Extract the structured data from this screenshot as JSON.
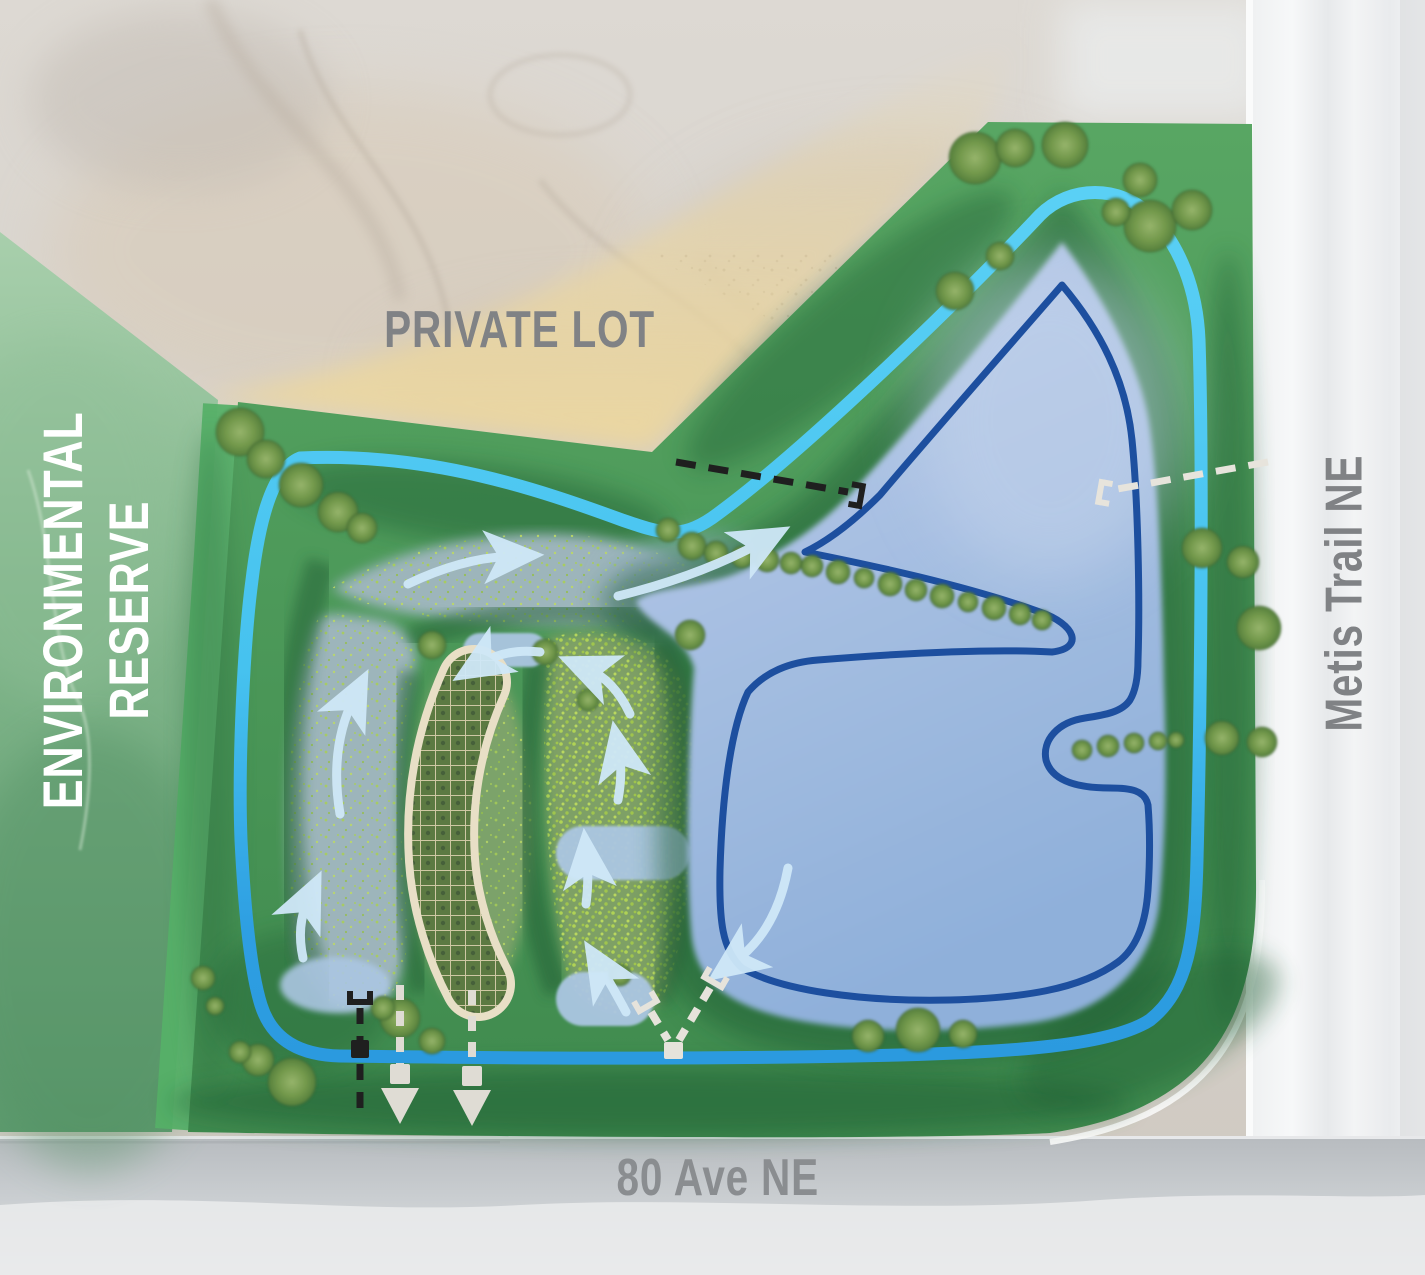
{
  "page": {
    "type": "stormwater pond and wetland landscape site plan"
  },
  "labels": {
    "private_lot": "PRIVATE LOT",
    "reserve_line1": "ENVIRONMENTAL",
    "reserve_line2": "RESERVE",
    "metis_trail": "Metis Trail NE",
    "ave_80": "80 Ave NE"
  },
  "features": {
    "pond": "stormwater-pond",
    "waterline": "normal-water-level-outline",
    "wetland": "constructed-wetland-marsh-cells",
    "grid_cell": "gridded-wetland-boardwalk-structure",
    "loop_path": "perimeter-pathway-loop",
    "flow_arrows": "water-flow-arrow-icon",
    "black_pipe": "storm-pipe-dashed-black-icon",
    "white_pipe": "storm-pipe-dashed-white-icon",
    "tee_marker": "pipe-inlet-tee-icon",
    "square_marker": "manhole-square-icon",
    "down_arrow": "outfall-arrow-icon",
    "tree": "tree-icon"
  },
  "colors": {
    "pathway_cyan": "#58CEF5",
    "pathway_blue": "#2D9DE0",
    "pond_fill": "#A9C1E2",
    "waterline_blue": "#1D4F9F",
    "park_green": "#4D9C59",
    "slope_green_dark": "#1F5E33",
    "reserve_green": "#7DB389",
    "private_lot_tan": "#ECD9A4",
    "road_gray": "#E9EBEC",
    "label_gray": "#808285",
    "arrow_light_blue": "#CFE8F8",
    "wetland_gray_green": "#A2B7C1",
    "structure_cream": "#E8DFC6"
  }
}
